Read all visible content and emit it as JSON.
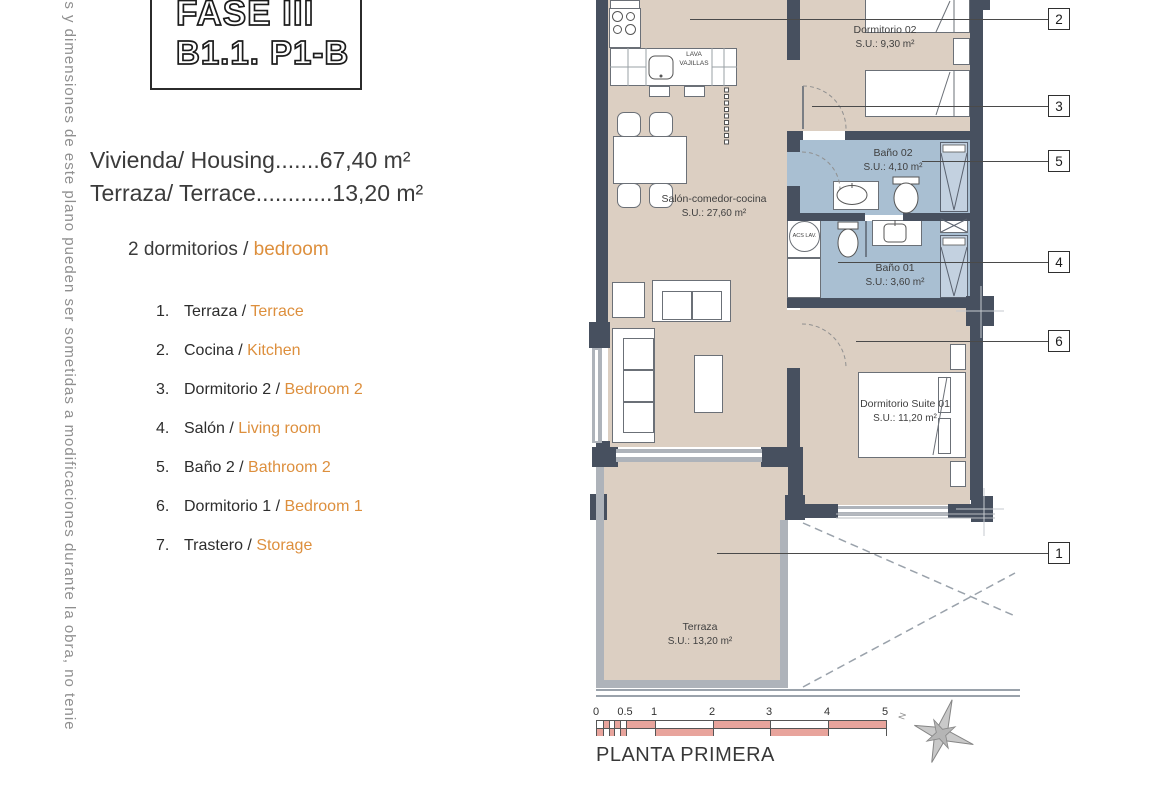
{
  "margin_note": "es y dimensiones de este plano pueden ser sometidas a modificaciones durante la obra, no tenie",
  "header": {
    "phase": "FASE III",
    "unit": "B1.1. P1-B"
  },
  "areas": [
    {
      "text": "Vivienda/ Housing.......67,40 m²"
    },
    {
      "text": "Terraza/ Terrace............13,20 m²"
    }
  ],
  "legend": {
    "title_es": "2 dormitorios / ",
    "title_en": "bedroom",
    "items": [
      {
        "num": "1.",
        "es": "Terraza / ",
        "en": "Terrace"
      },
      {
        "num": "2.",
        "es": "Cocina / ",
        "en": "Kitchen"
      },
      {
        "num": "3.",
        "es": "Dormitorio 2 / ",
        "en": "Bedroom 2"
      },
      {
        "num": "4.",
        "es": "Salón / ",
        "en": "Living room"
      },
      {
        "num": "5.",
        "es": "Baño 2 / ",
        "en": "Bathroom 2"
      },
      {
        "num": "6.",
        "es": "Dormitorio 1 / ",
        "en": "Bedroom 1"
      },
      {
        "num": "7.",
        "es": "Trastero / ",
        "en": "Storage"
      }
    ]
  },
  "plan": {
    "rooms": [
      {
        "name": "Dormitorio 02",
        "area": "S.U.: 9,30 m²"
      },
      {
        "name": "Baño 02",
        "area": "S.U.: 4,10 m²"
      },
      {
        "name": "Baño 01",
        "area": "S.U.: 3,60 m²"
      },
      {
        "name": "Salón-comedor-cocina",
        "area": "S.U.: 27,60 m²"
      },
      {
        "name": "Dormitorio Suite 01",
        "area": "S.U.: 11,20 m²"
      },
      {
        "name": "Terraza",
        "area": "S.U.: 13,20 m²"
      }
    ],
    "fixtures": {
      "dishwasher": "LAVA VAJILLAS",
      "water_heater": "ACS LAV."
    },
    "callouts": [
      "2",
      "3",
      "5",
      "4",
      "6",
      "1"
    ],
    "compass": "N"
  },
  "footer": {
    "floor": "PLANTA PRIMERA",
    "scale_ticks": [
      "0",
      "0.5",
      "1",
      "2",
      "3",
      "4",
      "5"
    ]
  },
  "colors": {
    "accent_orange": "#DD8F3D",
    "wall": "#47505F",
    "floor": "#DCCFC2",
    "bath": "#A9BFD2",
    "scale_pink": "#E8A49C"
  }
}
